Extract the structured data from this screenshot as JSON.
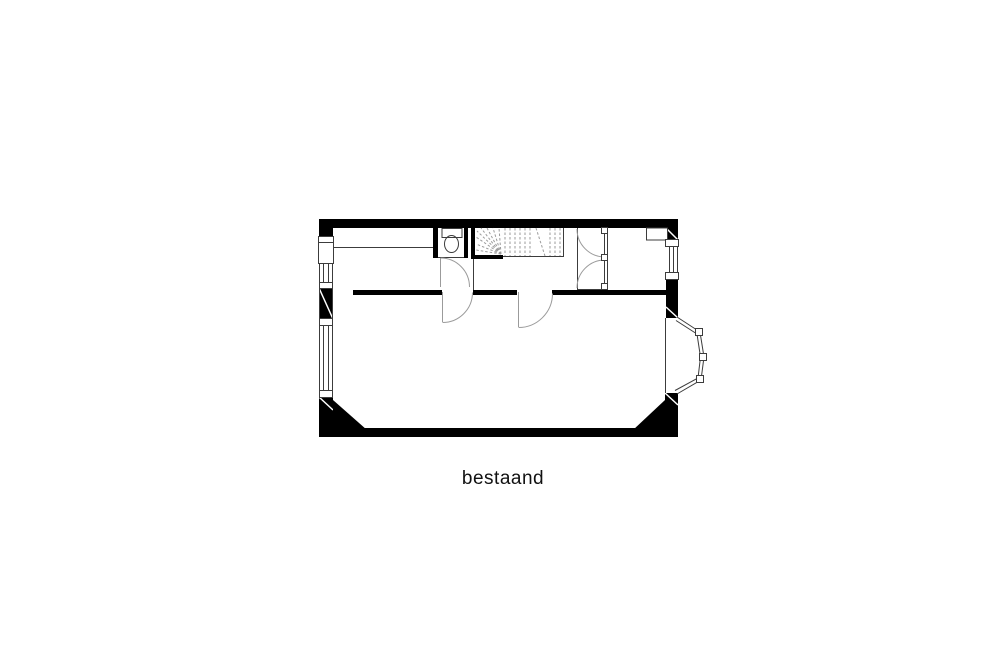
{
  "page": {
    "background_color": "#ffffff"
  },
  "plan": {
    "caption": "bestaand",
    "type": "architectural-floor-plan",
    "colors": {
      "wall": "#000000",
      "thin": "#3c3c3c",
      "light": "#9b9b9b",
      "bg": "#ffffff",
      "text": "#111111"
    },
    "features": [
      "exterior-walls",
      "left-facade-windows",
      "right-facade-window",
      "interior-wall-with-two-doors",
      "wc-with-toilet",
      "winder-stair",
      "double-swing-door",
      "niche",
      "bay-window",
      "chamfered-rear-corners"
    ]
  }
}
